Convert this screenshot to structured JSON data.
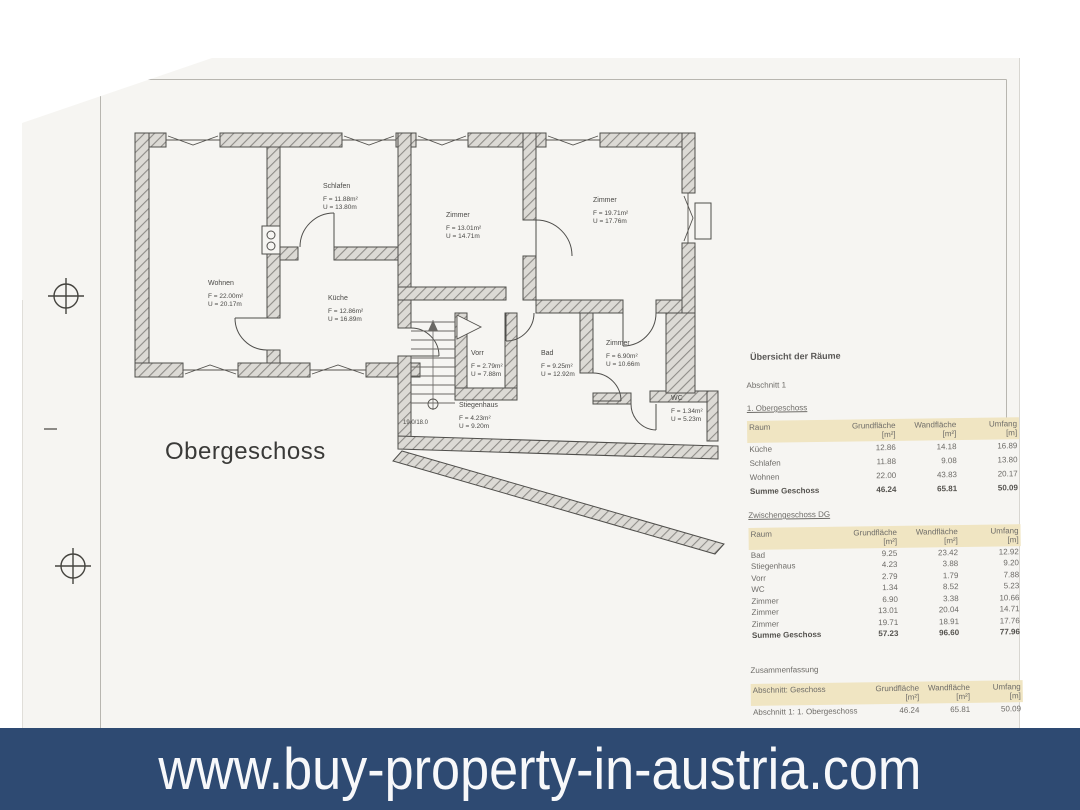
{
  "banner": {
    "url_text": "www.buy-property-in-austria.com",
    "background_color": "#2e4a72",
    "text_color": "#f7f8fa"
  },
  "drawing": {
    "title": "Obergeschoss",
    "stair_annotation": "19.0/18.0",
    "rooms": [
      {
        "name": "Wohnen",
        "area": "F = 22.00m²",
        "perimeter": "U = 20.17m"
      },
      {
        "name": "Schlafen",
        "area": "F = 11.88m²",
        "perimeter": "U = 13.80m"
      },
      {
        "name": "Zimmer",
        "area": "F = 13.01m²",
        "perimeter": "U = 14.71m"
      },
      {
        "name": "Zimmer",
        "area": "F = 19.71m²",
        "perimeter": "U = 17.76m"
      },
      {
        "name": "Küche",
        "area": "F = 12.86m²",
        "perimeter": "U = 16.89m"
      },
      {
        "name": "Vorr",
        "area": "F = 2.79m²",
        "perimeter": "U = 7.88m"
      },
      {
        "name": "Bad",
        "area": "F = 9.25m²",
        "perimeter": "U = 12.92m"
      },
      {
        "name": "Zimmer",
        "area": "F = 6.90m²",
        "perimeter": "U = 10.66m"
      },
      {
        "name": "Stiegenhaus",
        "area": "F = 4.23m²",
        "perimeter": "U = 9.20m"
      },
      {
        "name": "WC",
        "area": "F = 1.34m²",
        "perimeter": "U = 5.23m"
      }
    ]
  },
  "room_overview": {
    "title": "Übersicht der Räume",
    "section_label": "Abschnitt 1",
    "header_band_color": "#f0e5c2",
    "tables": [
      {
        "title": "1. Obergeschoss",
        "columns": [
          "Raum",
          "Grundfläche",
          "Wandfläche",
          "Umfang"
        ],
        "units": [
          "",
          "[m²]",
          "[m²]",
          "[m]"
        ],
        "rows": [
          [
            "Küche",
            "12.86",
            "14.18",
            "16.89"
          ],
          [
            "Schlafen",
            "11.88",
            "9.08",
            "13.80"
          ],
          [
            "Wohnen",
            "22.00",
            "43.83",
            "20.17"
          ]
        ],
        "total": [
          "Summe Geschoss",
          "46.24",
          "65.81",
          "50.09"
        ]
      },
      {
        "title": "Zwischengeschoss DG",
        "columns": [
          "Raum",
          "Grundfläche",
          "Wandfläche",
          "Umfang"
        ],
        "units": [
          "",
          "[m²]",
          "[m²]",
          "[m]"
        ],
        "rows": [
          [
            "Bad",
            "9.25",
            "23.42",
            "12.92"
          ],
          [
            "Stiegenhaus",
            "4.23",
            "3.88",
            "9.20"
          ],
          [
            "Vorr",
            "2.79",
            "1.79",
            "7.88"
          ],
          [
            "WC",
            "1.34",
            "8.52",
            "5.23"
          ],
          [
            "Zimmer",
            "6.90",
            "3.38",
            "10.66"
          ],
          [
            "Zimmer",
            "13.01",
            "20.04",
            "14.71"
          ],
          [
            "Zimmer",
            "19.71",
            "18.91",
            "17.76"
          ]
        ],
        "total": [
          "Summe Geschoss",
          "57.23",
          "96.60",
          "77.96"
        ]
      },
      {
        "title": "Zusammenfassung",
        "columns": [
          "Abschnitt: Geschoss",
          "Grundfläche",
          "Wandfläche",
          "Umfang"
        ],
        "units": [
          "",
          "[m²]",
          "[m²]",
          "[m]"
        ],
        "rows": [
          [
            "Abschnitt 1: 1. Obergeschoss",
            "46.24",
            "65.81",
            "50.09"
          ]
        ]
      }
    ]
  }
}
